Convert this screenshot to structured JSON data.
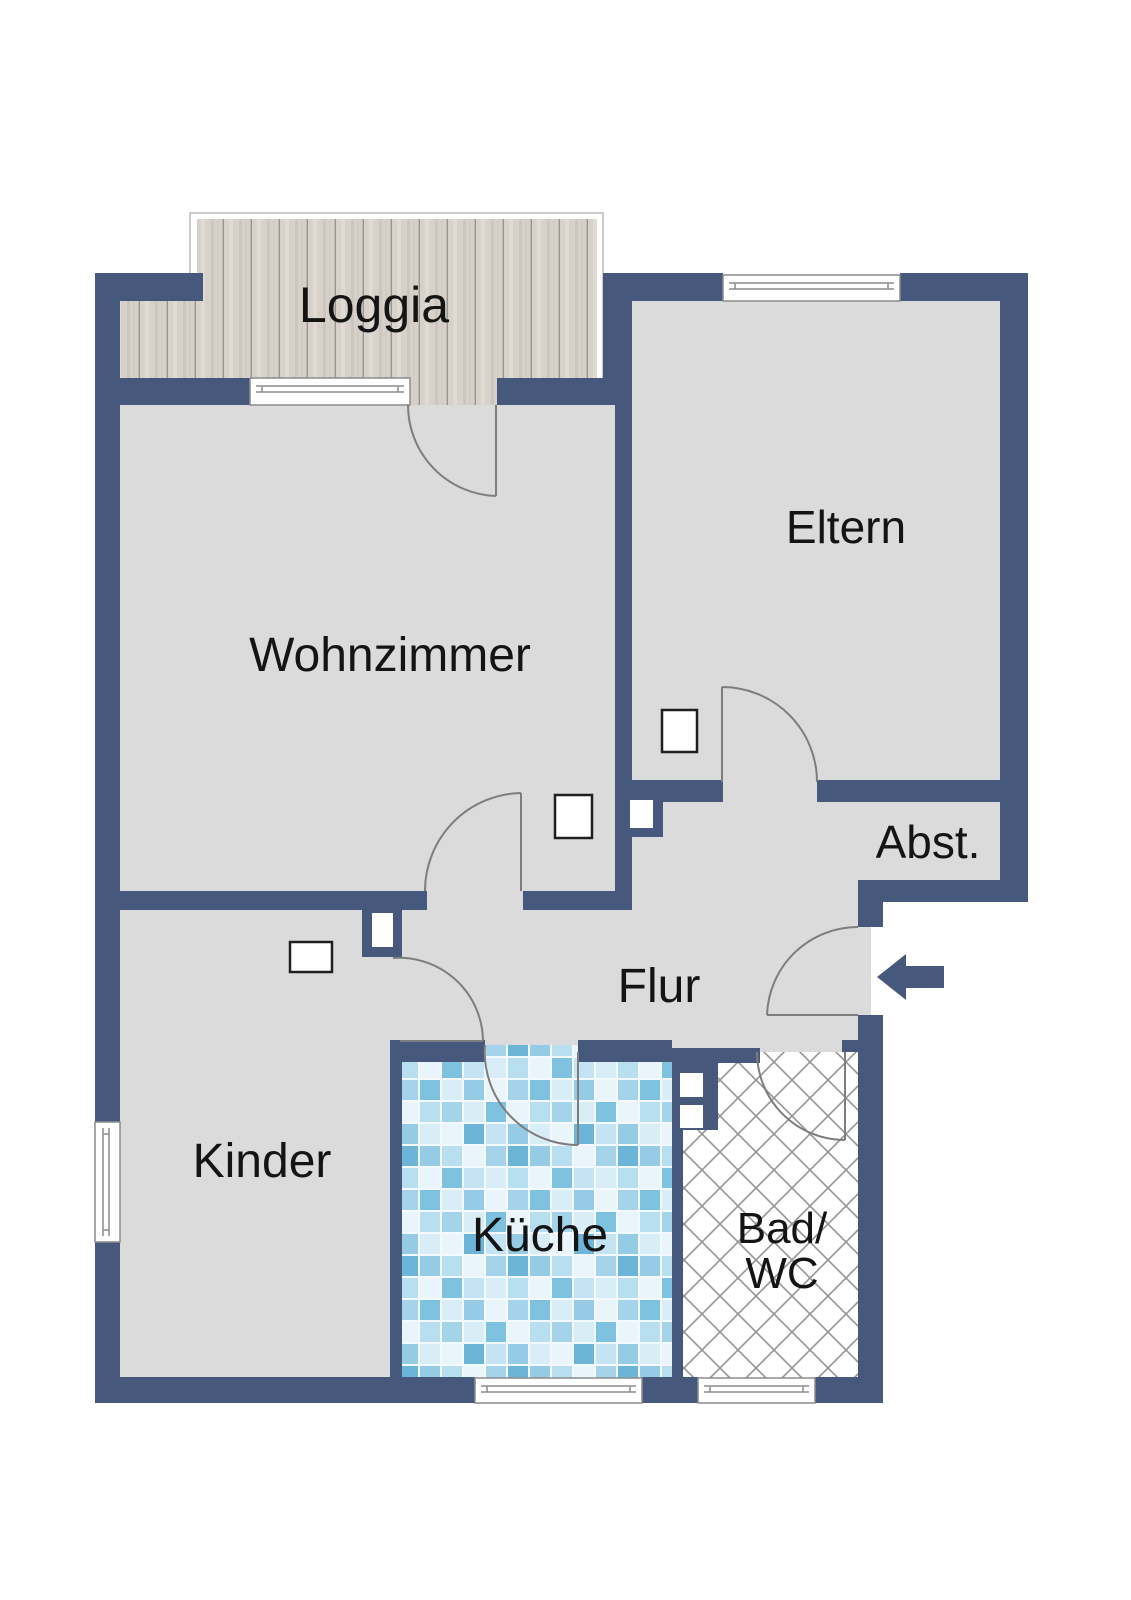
{
  "colors": {
    "wall": "#46587c",
    "floor": "#dbdbdb",
    "door_stroke": "#7d7d7d",
    "window_stroke": "#8c8c8c",
    "text": "#141414",
    "wood_base": "#d7d1ca",
    "tile_grout": "#f3fafd",
    "hatch_line": "#949494",
    "outside": "#ffffff"
  },
  "rooms": [
    {
      "id": "loggia",
      "label": "Loggia"
    },
    {
      "id": "wohnzimmer",
      "label": "Wohnzimmer"
    },
    {
      "id": "eltern",
      "label": "Eltern"
    },
    {
      "id": "abstellraum",
      "label": "Abst."
    },
    {
      "id": "flur",
      "label": "Flur"
    },
    {
      "id": "kinder",
      "label": "Kinder"
    },
    {
      "id": "kueche",
      "label": "Küche"
    },
    {
      "id": "bad_wc",
      "label": "Bad/",
      "label2": "WC"
    }
  ],
  "entry": {
    "icon": "arrow-left",
    "meaning": "entrance"
  }
}
